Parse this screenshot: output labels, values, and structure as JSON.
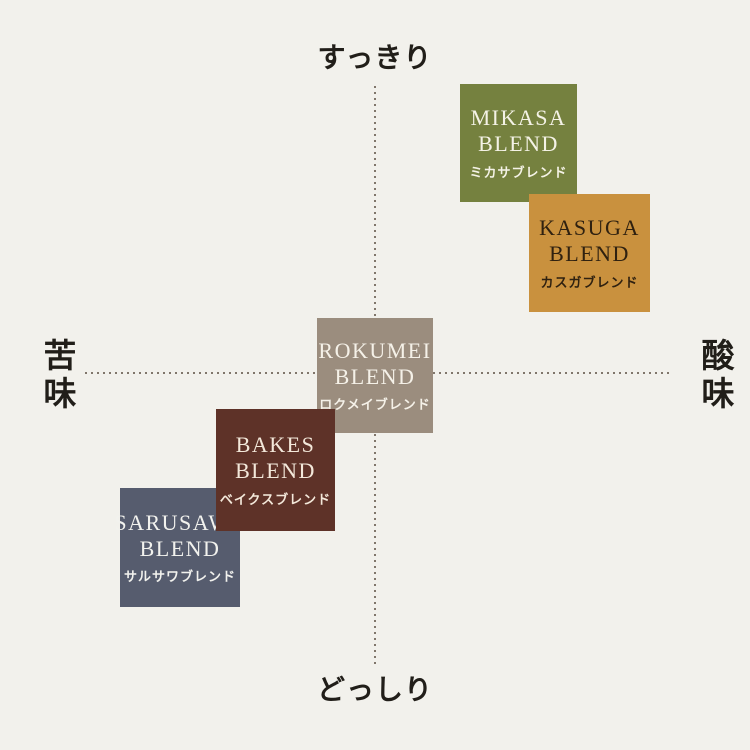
{
  "page": {
    "background_color": "#f2f1ec"
  },
  "chart_data": {
    "type": "scatter",
    "description": "Coffee blend taste positioning map: four-direction quadrant chart with five blend tiles",
    "axes": {
      "top_label": "すっきり",
      "bottom_label": "どっしり",
      "left_label": "苦味",
      "right_label": "酸味",
      "x_axis_meaning": "苦味 (bitter, left) ↔ 酸味 (acidic, right)",
      "y_axis_meaning": "どっしり (heavy, bottom) ↔ すっきり (clean, top)",
      "x_range": [
        -1,
        1
      ],
      "y_range": [
        -1,
        1
      ],
      "line_style": "dotted",
      "line_color": "#80766b",
      "label_color": "#211e19"
    },
    "points": [
      {
        "id": "mikasa",
        "name_en": "MIKASA BLEND",
        "name_ja": "ミカサブレンド",
        "x": 0.49,
        "y": 0.79,
        "color": "#75813f",
        "text_color": "#f4f2e6",
        "rect": {
          "left": 460,
          "top": 84,
          "width": 117,
          "height": 118
        },
        "z": 1
      },
      {
        "id": "kasuga",
        "name_en": "KASUGA BLEND",
        "name_ja": "カスガブレンド",
        "x": 0.73,
        "y": 0.41,
        "color": "#c9913e",
        "text_color": "#2f2110",
        "rect": {
          "left": 529,
          "top": 194,
          "width": 121,
          "height": 118
        },
        "z": 2
      },
      {
        "id": "rokumei",
        "name_en": "ROKUMEI BLEND",
        "name_ja": "ロクメイブレンド",
        "x": 0.0,
        "y": 0.0,
        "color": "#9b8d7e",
        "text_color": "#f5f1e8",
        "rect": {
          "left": 317,
          "top": 318,
          "width": 116,
          "height": 115
        },
        "z": 1
      },
      {
        "id": "bakes",
        "name_en": "BAKES BLEND",
        "name_ja": "ベイクスブレンド",
        "x": -0.34,
        "y": -0.33,
        "color": "#5e3228",
        "text_color": "#f3e8da",
        "rect": {
          "left": 216,
          "top": 409,
          "width": 119,
          "height": 122
        },
        "z": 2
      },
      {
        "id": "sarusawa",
        "name_en": "SARUSAWA BLEND",
        "name_ja": "サルサワブレンド",
        "x": -0.67,
        "y": -0.6,
        "color": "#565c6e",
        "text_color": "#f2f2ee",
        "rect": {
          "left": 120,
          "top": 488,
          "width": 120,
          "height": 119
        },
        "z": 1
      }
    ]
  }
}
